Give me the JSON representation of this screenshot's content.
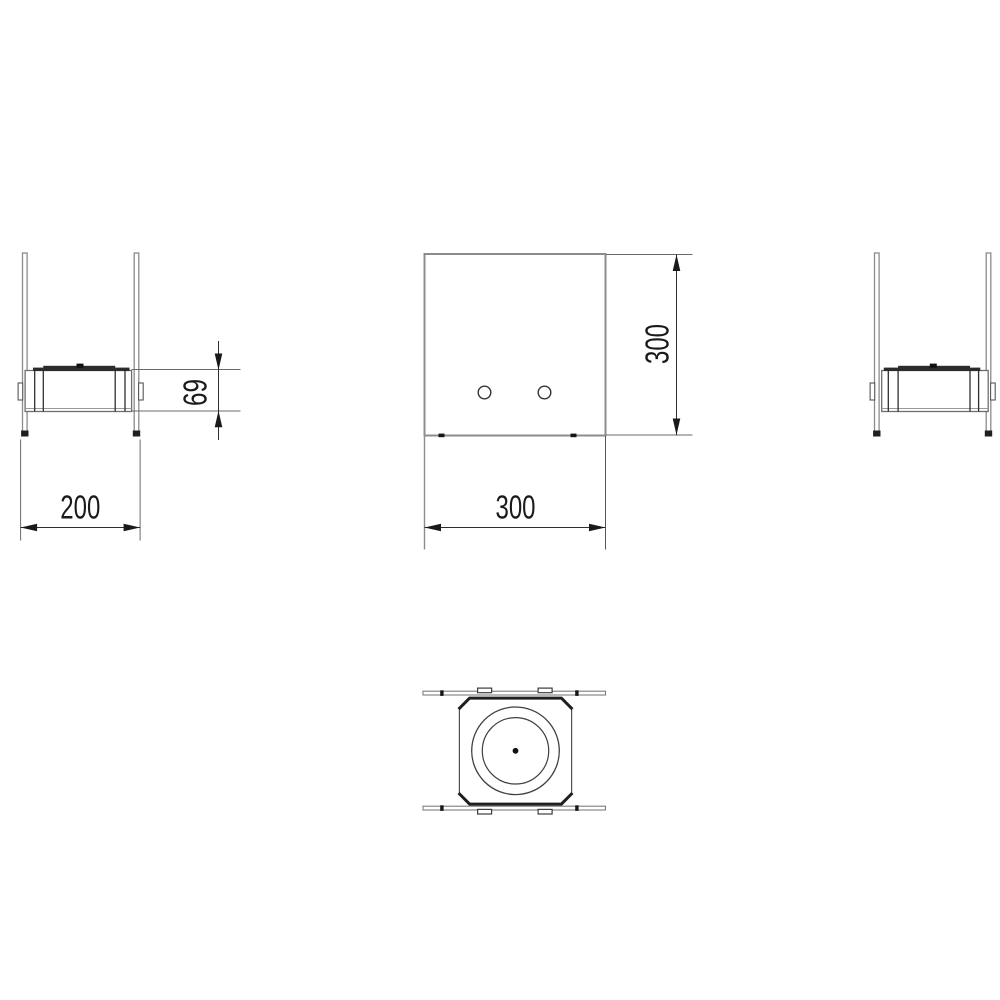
{
  "drawing": {
    "background_color": "#ffffff",
    "part_line_color": "#8c8c8c",
    "detail_color": "#262626",
    "dimension_line_color": "#2e2e2e",
    "views": {
      "side_left": {
        "width_dim": "200",
        "burner_height_dim": "69"
      },
      "front": {
        "width_dim": "300",
        "height_dim": "300"
      }
    }
  }
}
